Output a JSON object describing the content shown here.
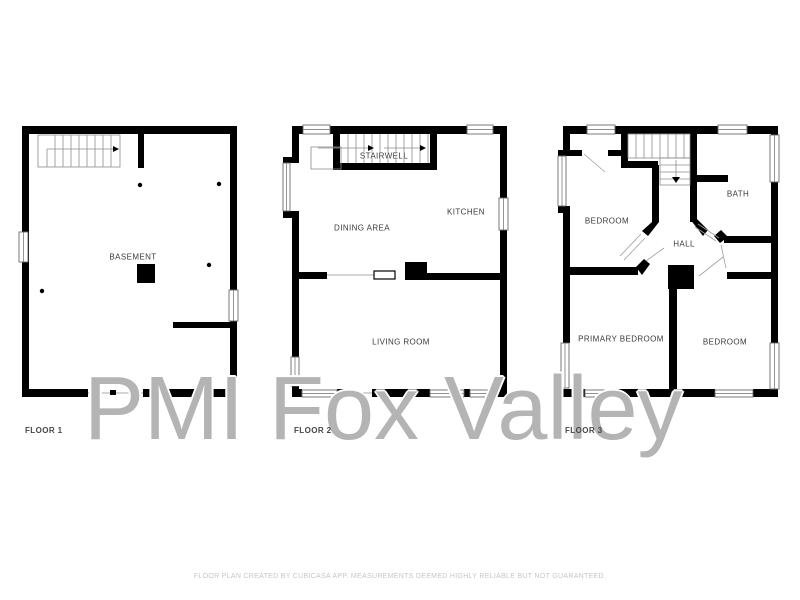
{
  "page": {
    "background": "#ffffff"
  },
  "watermark": {
    "text": "PMI Fox Valley"
  },
  "footer": {
    "text": "FLOOR PLAN CREATED BY CUBICASA APP. MEASUREMENTS DEEMED HIGHLY RELIABLE BUT NOT GUARANTEED."
  },
  "colors": {
    "wall": "#000000",
    "thin_line": "#8c8c8c",
    "room_label": "#3a3a3a",
    "floor_label": "#474747",
    "watermark": "#b4b4b4",
    "footer_text": "#c6c6c6"
  },
  "floors": [
    {
      "label": "FLOOR 1",
      "rooms": [
        {
          "name": "BASEMENT"
        }
      ]
    },
    {
      "label": "FLOOR 2",
      "rooms": [
        {
          "name": "STAIRWELL"
        },
        {
          "name": "DINING AREA"
        },
        {
          "name": "KITCHEN"
        },
        {
          "name": "LIVING ROOM"
        }
      ]
    },
    {
      "label": "FLOOR 3",
      "rooms": [
        {
          "name": "BEDROOM"
        },
        {
          "name": "BATH"
        },
        {
          "name": "HALL"
        },
        {
          "name": "PRIMARY BEDROOM"
        },
        {
          "name": "BEDROOM"
        }
      ]
    }
  ]
}
